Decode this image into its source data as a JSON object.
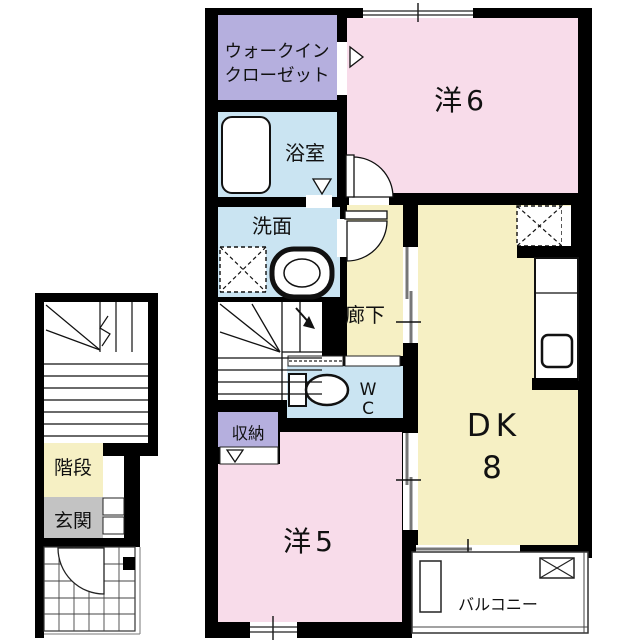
{
  "plan": {
    "floor2": {
      "walk_in_closet": {
        "label_line1": "ウォークイン",
        "label_line2": "クローゼット"
      },
      "bathroom": {
        "label": "浴室"
      },
      "washroom": {
        "label": "洗面"
      },
      "hallway": {
        "label": "廊下"
      },
      "wc": {
        "label_line1": "W",
        "label_line2": "C"
      },
      "storage": {
        "label": "収納"
      },
      "western_room_6": {
        "label": "洋6"
      },
      "western_room_5": {
        "label": "洋5"
      },
      "dining_kitchen": {
        "label_line1": "DK",
        "label_line2": "8"
      },
      "balcony": {
        "label": "バルコニー"
      }
    },
    "floor1": {
      "stairs": {
        "label": "階段"
      },
      "entrance": {
        "label": "玄関"
      }
    },
    "colors": {
      "room_pink": "#f8dcea",
      "room_purple": "#b5afde",
      "room_blue": "#cae4f2",
      "room_cream": "#f6f0c4",
      "entrance_gray": "#c3c3c3",
      "wall_black": "#000000"
    }
  }
}
